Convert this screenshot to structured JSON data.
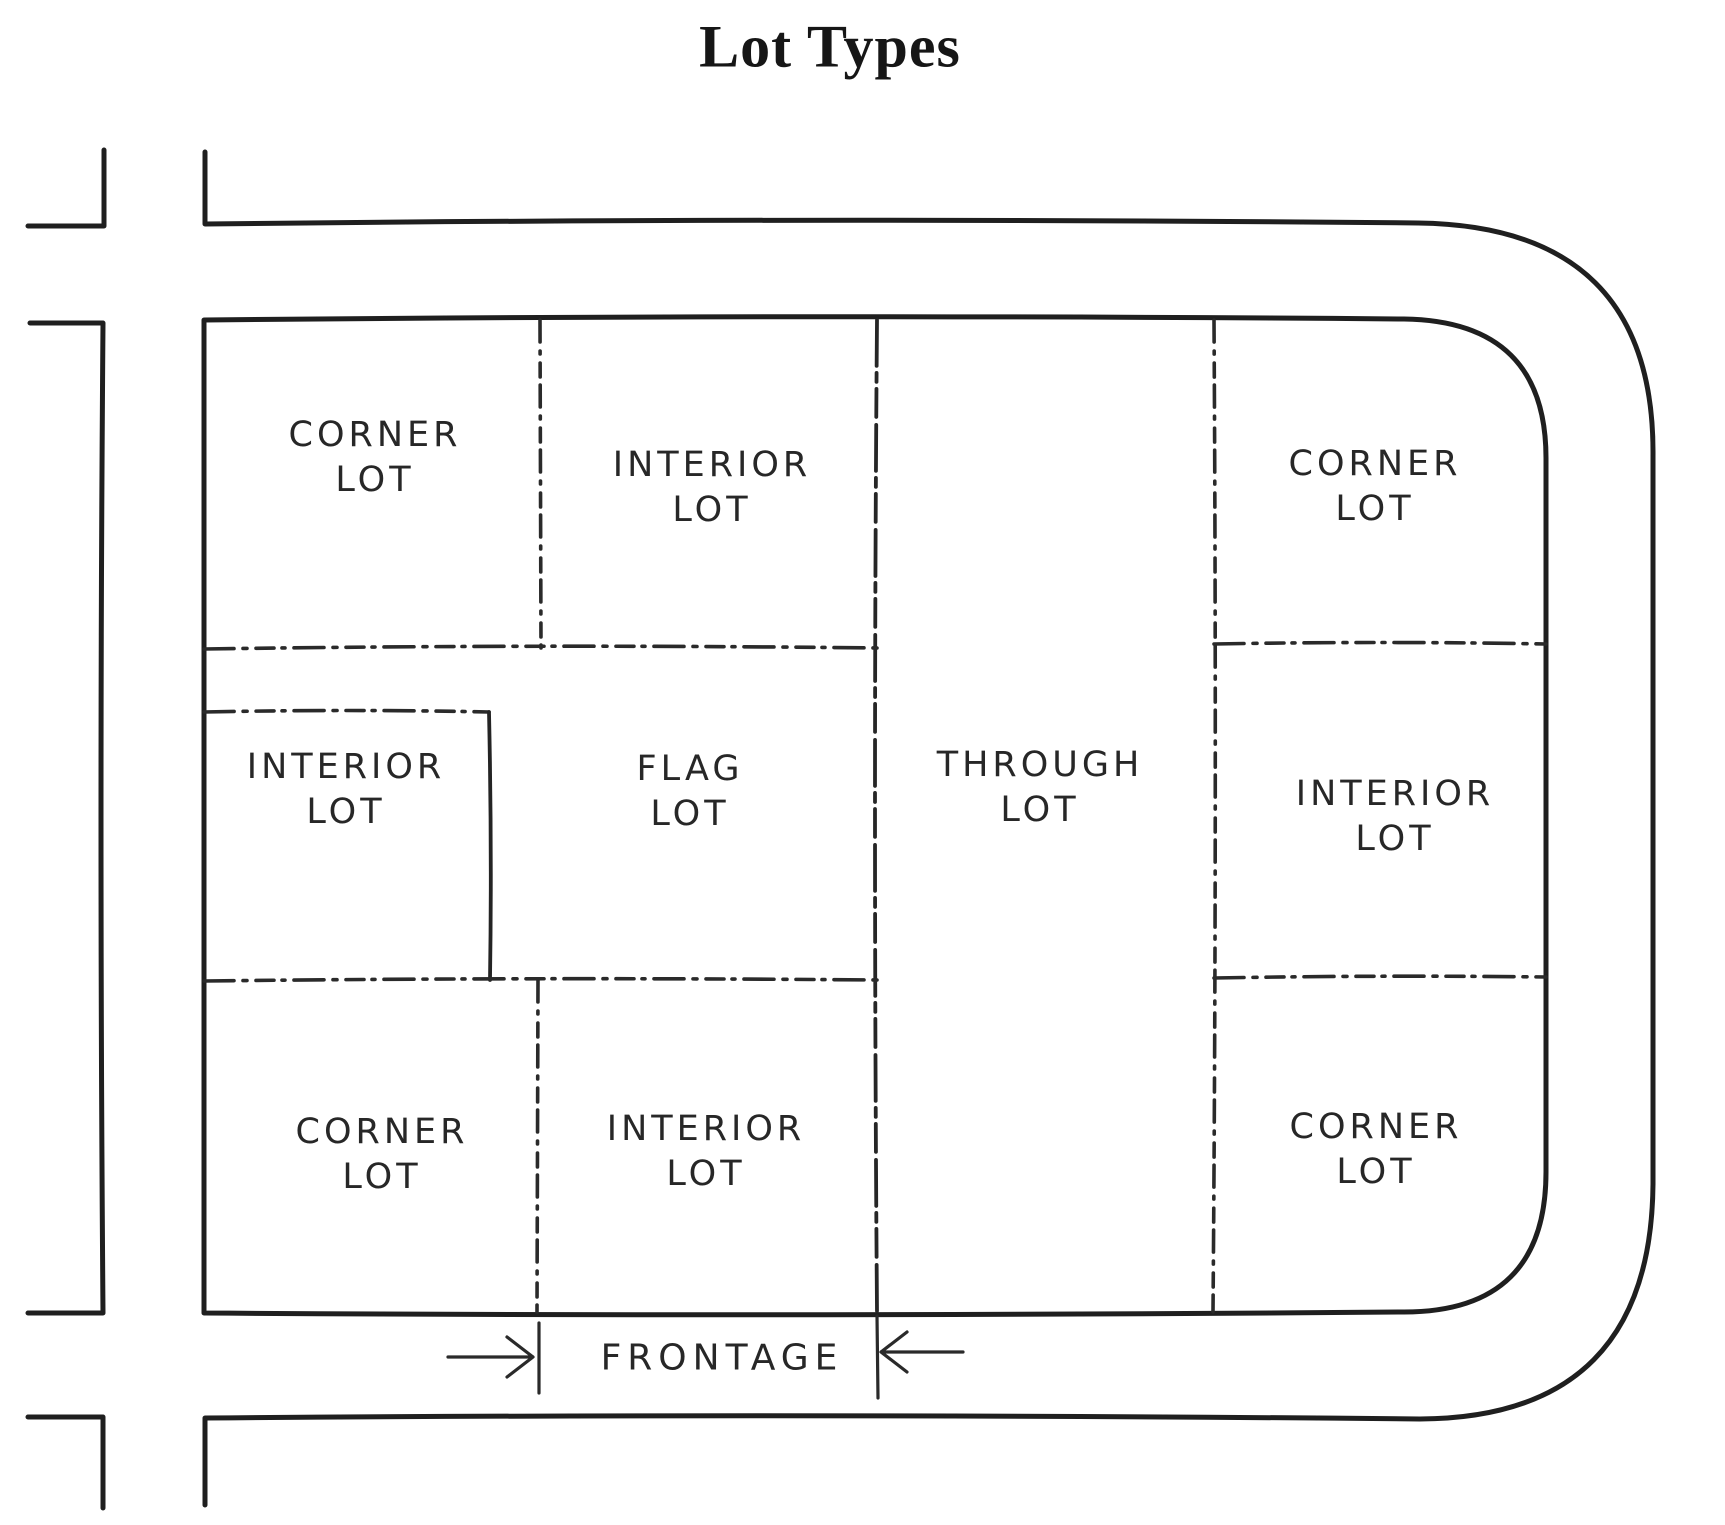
{
  "title": "Lot Types",
  "lots": [
    {
      "id": "corner-top-left",
      "line1": "CORNER",
      "line2": "LOT"
    },
    {
      "id": "interior-top",
      "line1": "INTERIOR",
      "line2": "LOT"
    },
    {
      "id": "corner-top-right",
      "line1": "CORNER",
      "line2": "LOT"
    },
    {
      "id": "interior-mid-left",
      "line1": "INTERIOR",
      "line2": "LOT"
    },
    {
      "id": "flag",
      "line1": "FLAG",
      "line2": "LOT"
    },
    {
      "id": "through",
      "line1": "THROUGH",
      "line2": "LOT"
    },
    {
      "id": "interior-mid-right",
      "line1": "INTERIOR",
      "line2": "LOT"
    },
    {
      "id": "corner-bottom-left",
      "line1": "CORNER",
      "line2": "LOT"
    },
    {
      "id": "interior-bottom",
      "line1": "INTERIOR",
      "line2": "LOT"
    },
    {
      "id": "corner-bottom-right",
      "line1": "CORNER",
      "line2": "LOT"
    }
  ],
  "annotation": {
    "frontage_label": "FRONTAGE"
  },
  "colors": {
    "ink": "#1f1f1f",
    "background": "#ffffff"
  }
}
